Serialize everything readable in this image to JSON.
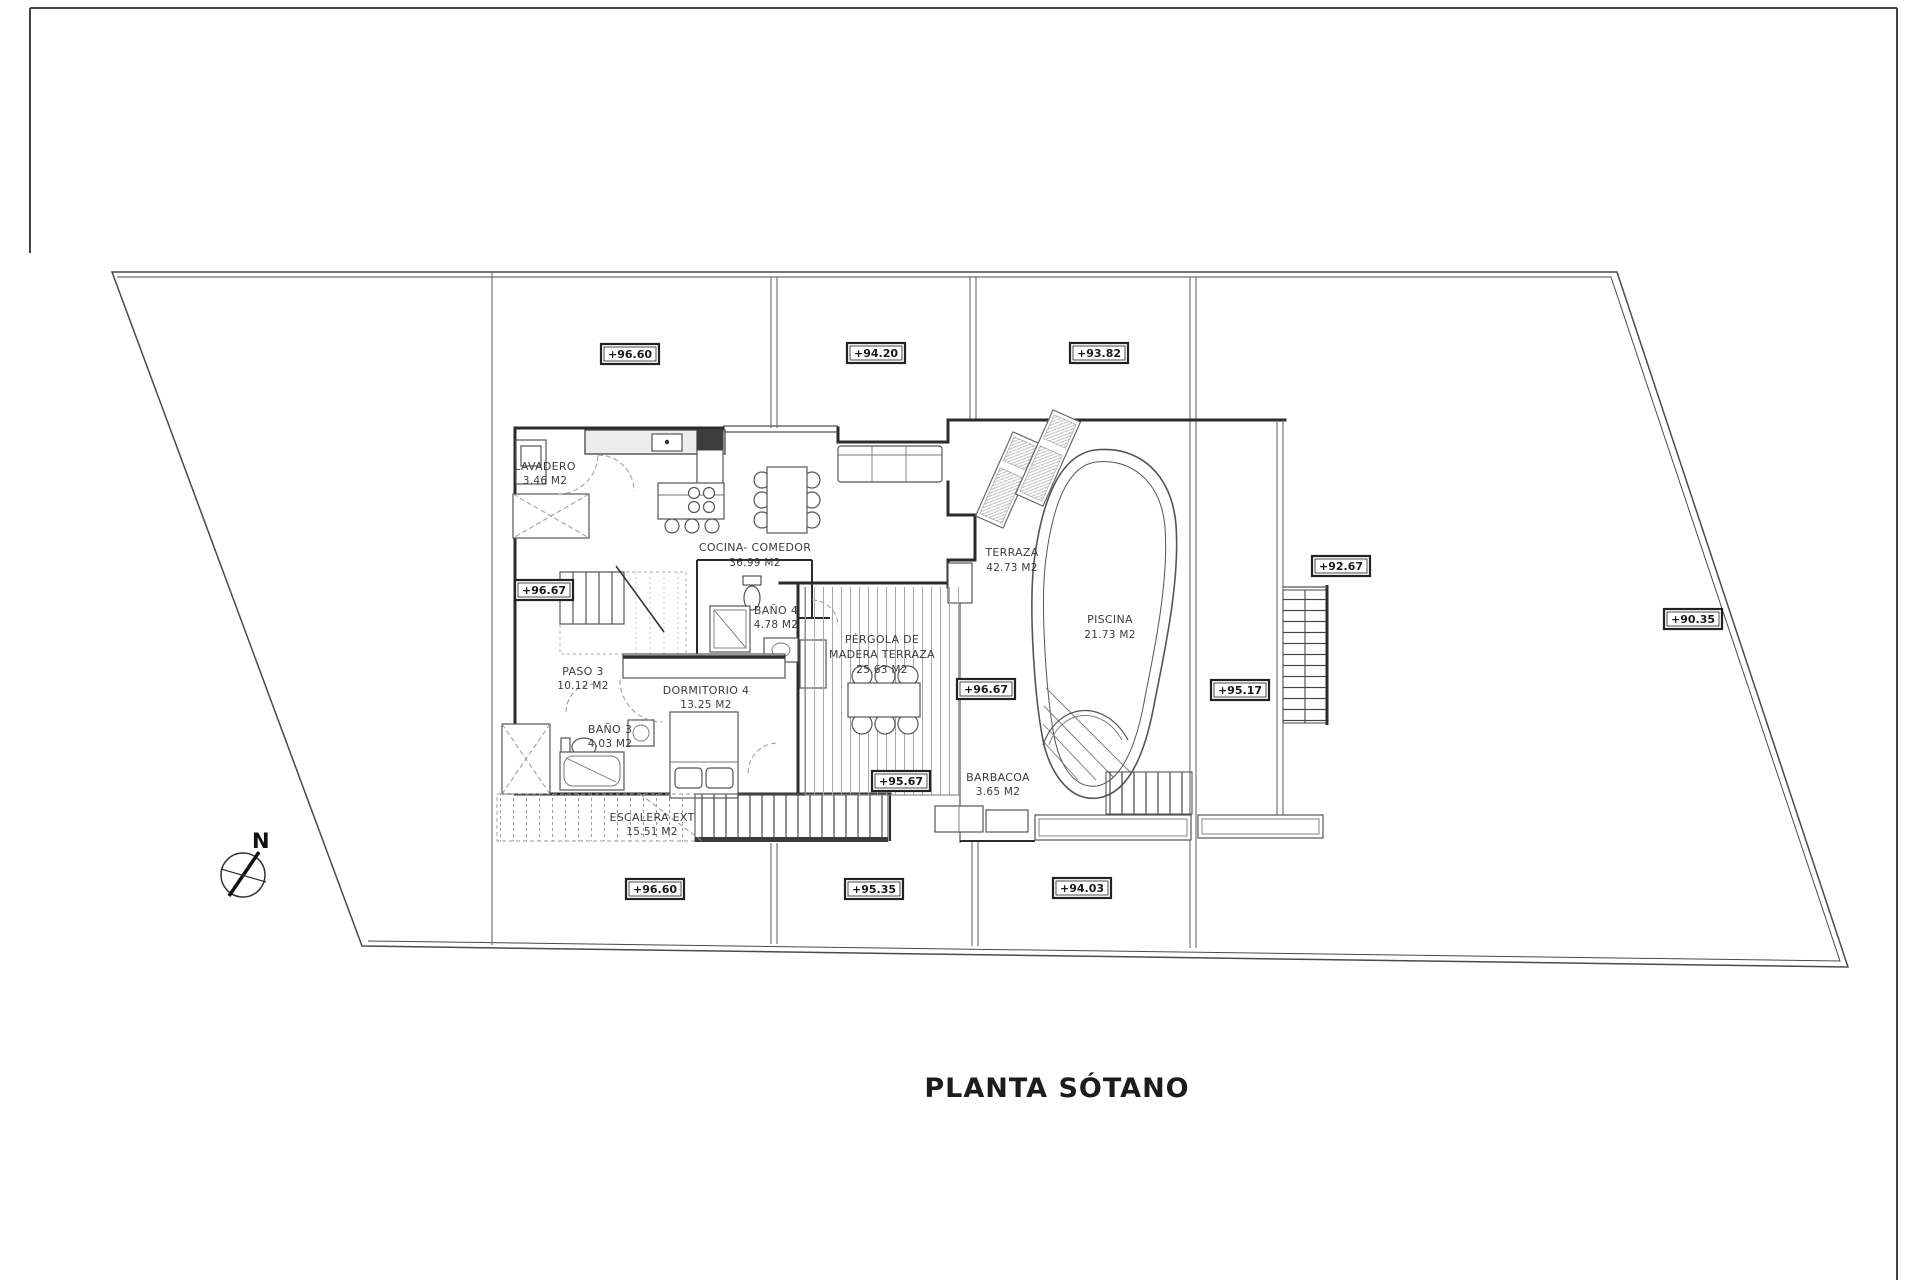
{
  "sheet": {
    "title": "PLANTA SÓTANO",
    "paper_color": "#ffffff",
    "ink_color": "#2b2b2b",
    "hatch_color": "#9a9a9a"
  },
  "compass": {
    "label": "N"
  },
  "rooms": {
    "lavadero": {
      "name": "LAVADERO",
      "area": "3.46 M2"
    },
    "cocina": {
      "name": "COCINA- COMEDOR",
      "area": "36.99 M2"
    },
    "bano4": {
      "name": "BAÑO 4",
      "area": "4.78 M2"
    },
    "paso3": {
      "name": "PASO 3",
      "area": "10.12 M2"
    },
    "dormitorio4": {
      "name": "DORMITORIO 4",
      "area": "13.25 M2"
    },
    "bano3": {
      "name": "BAÑO 3",
      "area": "4.03 M2"
    },
    "escalera": {
      "name": "ESCALERA EXT",
      "area": "15.51 M2"
    },
    "pergola": {
      "name1": "PÉRGOLA DE",
      "name2": "MADERA TERRAZA",
      "area": "25.63 M2"
    },
    "terraza": {
      "name": "TERRAZA",
      "area": "42.73 M2"
    },
    "piscina": {
      "name": "PISCINA",
      "area": "21.73 M2"
    },
    "barbacoa": {
      "name": "BARBACOA",
      "area": "3.65 M2"
    }
  },
  "levels": {
    "top_left": "+96.60",
    "top_mid": "+94.20",
    "top_right": "+93.82",
    "stair_int": "+96.67",
    "right_upper": "+92.67",
    "far_right": "+90.35",
    "terrace_mid": "+96.67",
    "pool_right": "+95.17",
    "pergola_low": "+95.67",
    "bottom_left": "+96.60",
    "bottom_mid": "+95.35",
    "bottom_right": "+94.03"
  }
}
